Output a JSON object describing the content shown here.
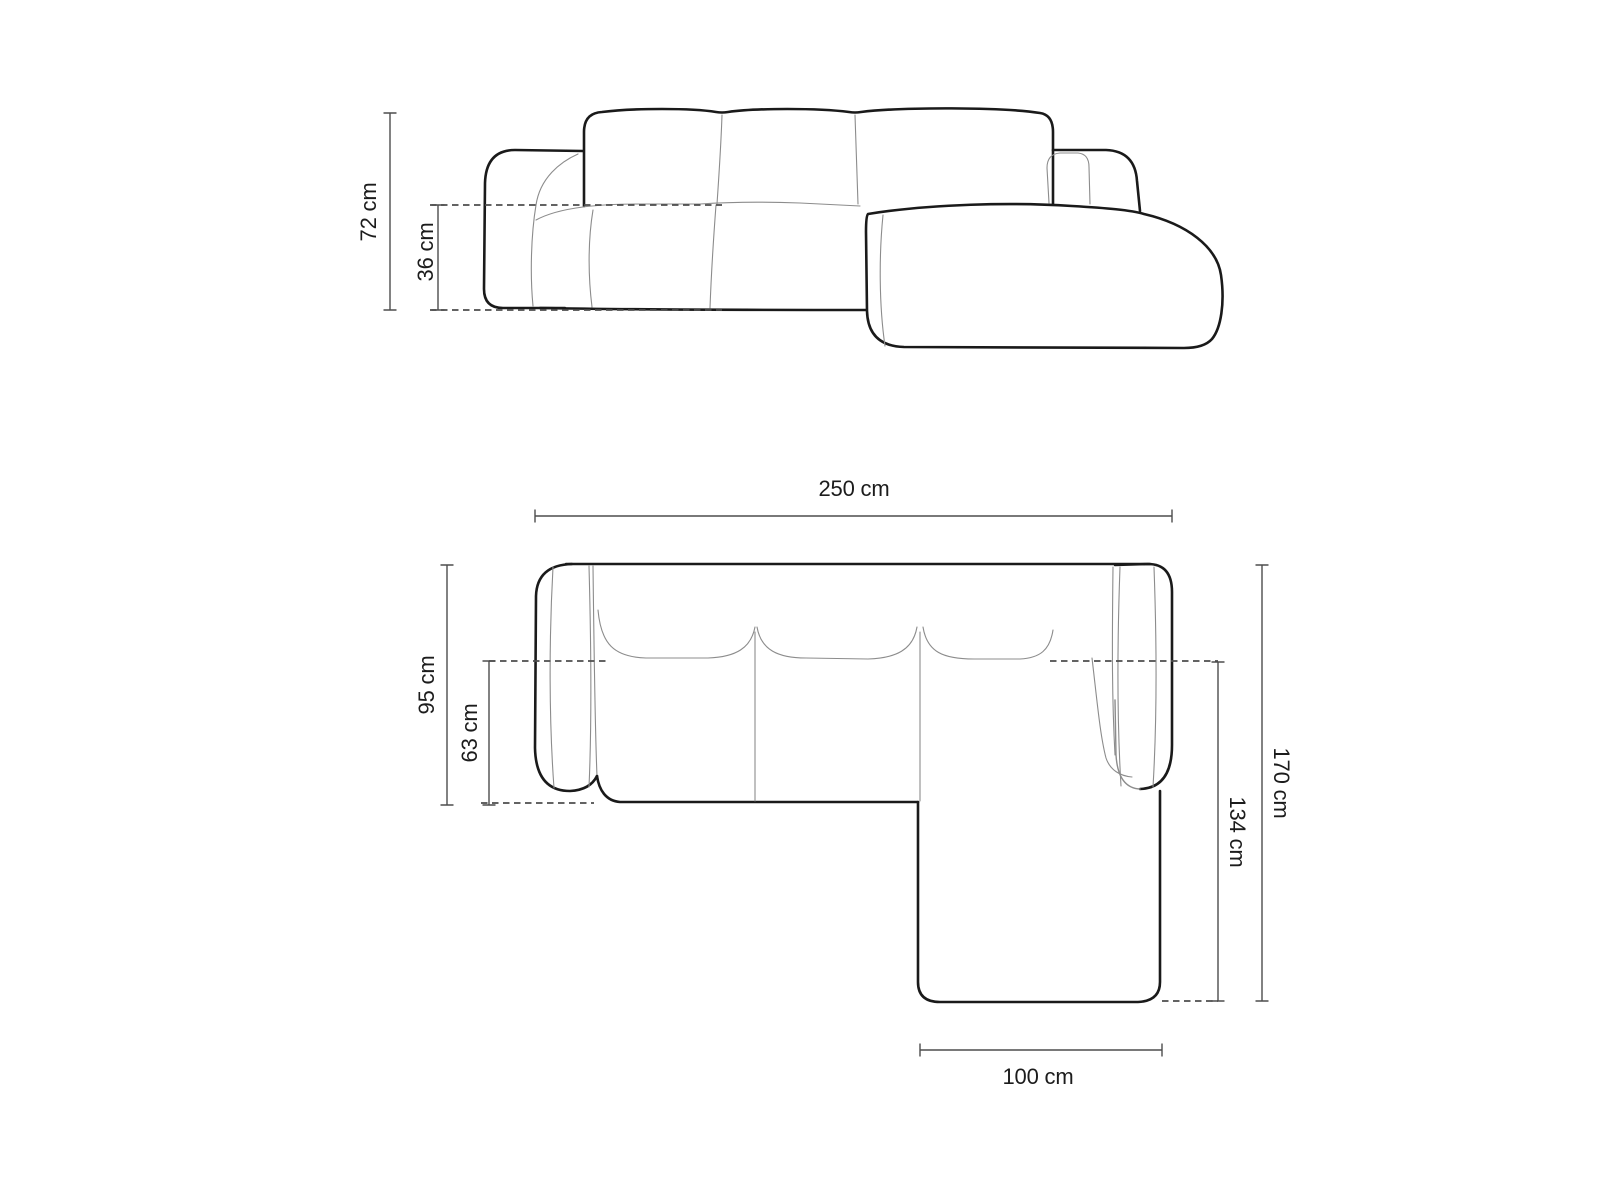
{
  "diagram": {
    "type": "furniture-dimension-drawing",
    "subject": "corner-sofa-with-right-chaise",
    "units": "cm",
    "labels": {
      "height_total": "72 cm",
      "height_seat": "36 cm",
      "width_total": "250 cm",
      "depth_body": "95 cm",
      "depth_seat": "63 cm",
      "depth_total": "170 cm",
      "length_chaise": "134 cm",
      "width_chaise": "100 cm"
    },
    "dimensions": [
      {
        "view": "front",
        "key": "height_total",
        "value": 72,
        "unit": "cm"
      },
      {
        "view": "front",
        "key": "height_seat",
        "value": 36,
        "unit": "cm"
      },
      {
        "view": "top",
        "key": "width_total",
        "value": 250,
        "unit": "cm"
      },
      {
        "view": "top",
        "key": "depth_body",
        "value": 95,
        "unit": "cm"
      },
      {
        "view": "top",
        "key": "depth_seat",
        "value": 63,
        "unit": "cm"
      },
      {
        "view": "top",
        "key": "depth_total",
        "value": 170,
        "unit": "cm"
      },
      {
        "view": "top",
        "key": "length_chaise",
        "value": 134,
        "unit": "cm"
      },
      {
        "view": "top",
        "key": "width_chaise",
        "value": 100,
        "unit": "cm"
      }
    ],
    "colors": {
      "background": "#ffffff",
      "outline": "#1a1a1a",
      "light_line": "#8c8c8c",
      "dimension_line": "#4d4d4d",
      "label_text": "#1c1c1c"
    }
  }
}
